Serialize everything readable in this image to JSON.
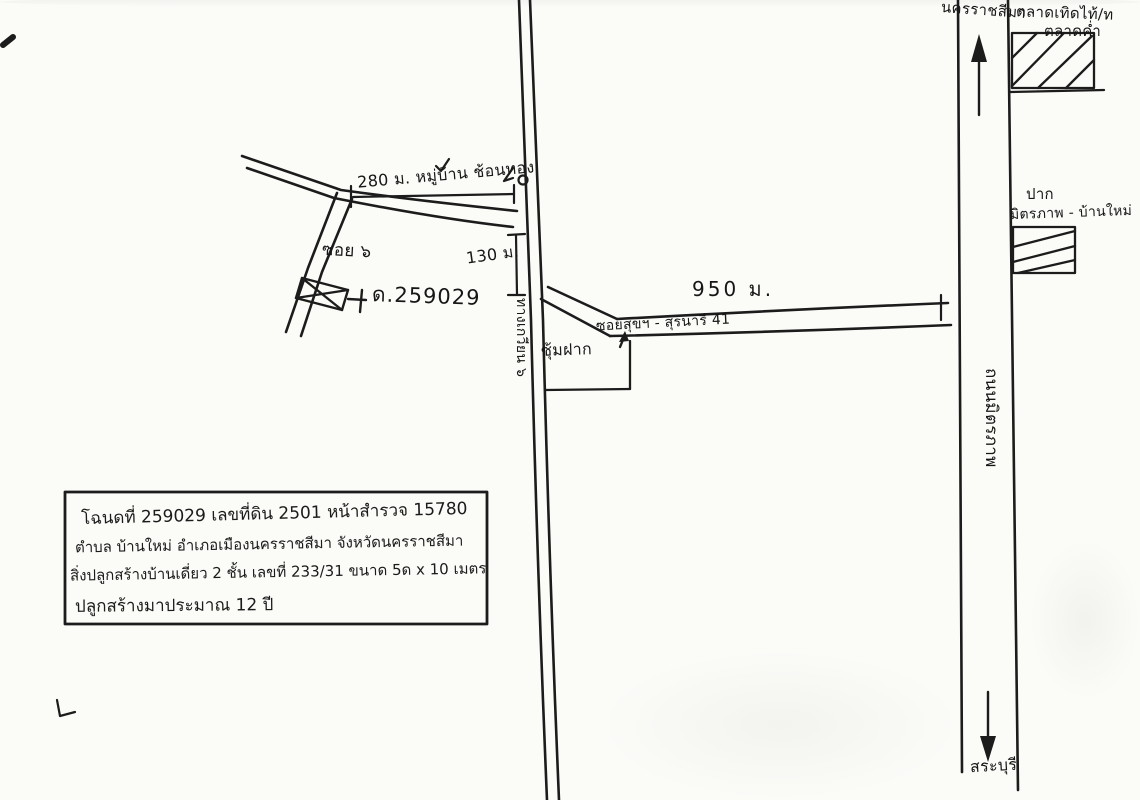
{
  "map": {
    "title_hint": "hand-drawn land location sketch",
    "colors": {
      "ink": "#1c1c1c",
      "paper": "#fbfbf8"
    },
    "north_city": "นครราชสีมา",
    "market_line1": "ตลาดเทิดไท้/ท",
    "market_line2": "ตลาดค่ำ",
    "pak_label": "ปาก",
    "pak_road": "มิตรภาพ - บ้านใหม่",
    "highway_name": "ถนนมิตรภาพ",
    "south_city": "สระบุรี",
    "village_distance": "280 ม. หมู่บ้าน ช้อนทอง",
    "soi6": "ซอย ๖",
    "parcel_no": "ด.259029",
    "dist_130": "130 ม.",
    "dist_950": "950 ม.",
    "soi41": "ซอยสุขฯ - สุรนารี 41",
    "gate_shop": "ซุ้มฝาก",
    "side_road": "ทางเกวียน ๖"
  },
  "infobox": {
    "line1": "โฉนดที่ 259029 เลขที่ดิน 2501 หน้าสำรวจ 15780",
    "line2": "ตำบล บ้านใหม่ อำเภอเมืองนครราชสีมา จังหวัดนครราชสีมา",
    "line3": "สิ่งปลูกสร้างบ้านเดี่ยว 2 ชั้น เลขที่ 233/31 ขนาด 5ด x 10 เมตร",
    "line4": "ปลูกสร้างมาประมาณ 12 ปี"
  }
}
